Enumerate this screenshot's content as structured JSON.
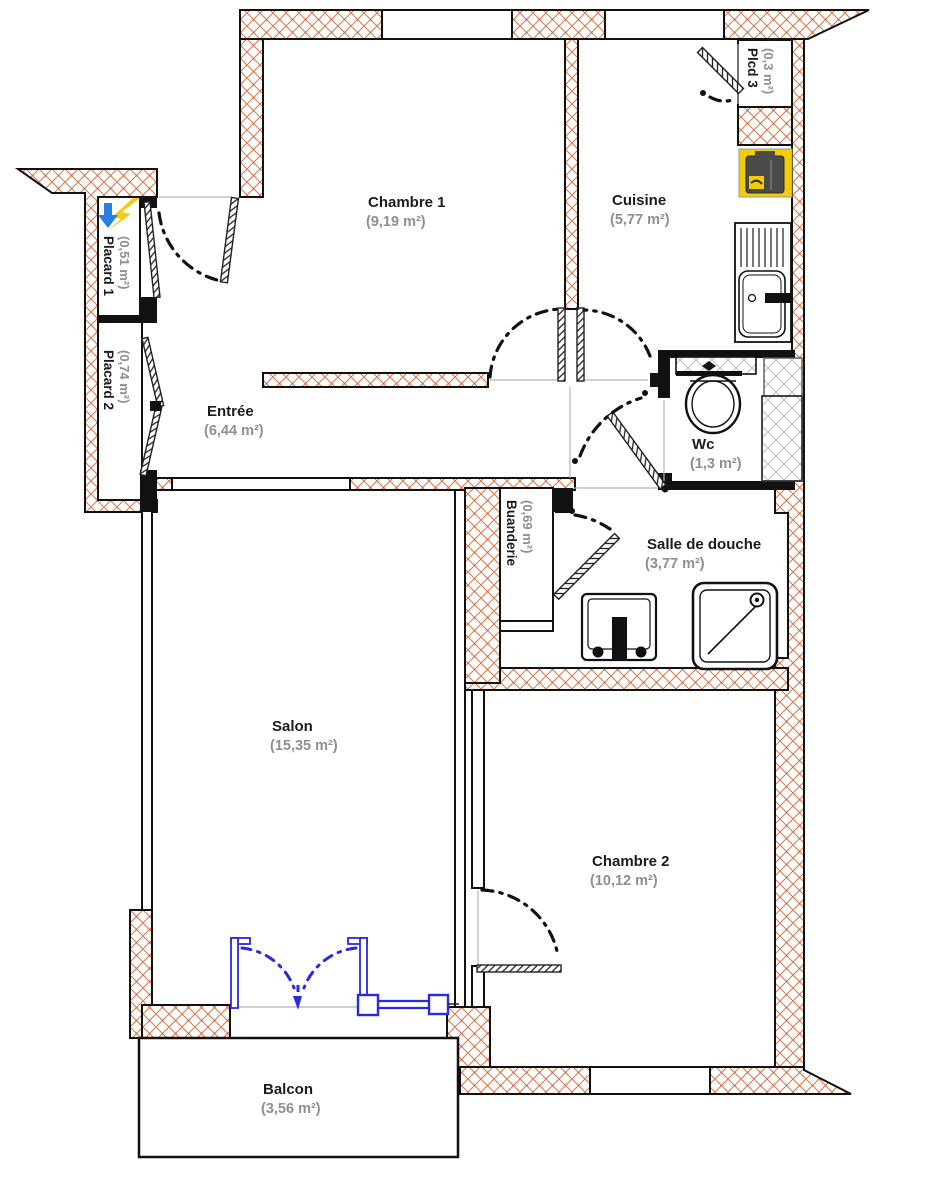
{
  "plan": {
    "title": "apartment-floor-plan",
    "rooms": {
      "chambre1": {
        "name": "Chambre 1",
        "area": "(9,19 m²)"
      },
      "cuisine": {
        "name": "Cuisine",
        "area": "(5,77 m²)"
      },
      "entree": {
        "name": "Entrée",
        "area": "(6,44 m²)"
      },
      "wc": {
        "name": "Wc",
        "area": "(1,3 m²)"
      },
      "salle_de_douche": {
        "name": "Salle de douche",
        "area": "(3,77 m²)"
      },
      "salon": {
        "name": "Salon",
        "area": "(15,35 m²)"
      },
      "chambre2": {
        "name": "Chambre 2",
        "area": "(10,12 m²)"
      },
      "balcon": {
        "name": "Balcon",
        "area": "(3,56 m²)"
      },
      "placard1": {
        "name": "Placard 1",
        "area": "(0,51 m²)"
      },
      "placard2": {
        "name": "Placard 2",
        "area": "(0,74 m²)"
      },
      "placard3": {
        "name": "Plcd 3",
        "area": "(0,3 m²)"
      },
      "buanderie": {
        "name": "Buanderie",
        "area": "(0,69 m²)"
      }
    },
    "icons": {
      "kitchen_sink": "sink-with-drainer-icon",
      "stove": "stove-icon",
      "toilet": "toilet-icon",
      "washbasin": "washbasin-icon",
      "shower": "shower-tray-icon",
      "electric_panel": "electric-panel-icon",
      "balcony_doors": "french-doors-icon",
      "balcony_window": "window-icon"
    },
    "colors": {
      "wall_hatch": "#dd7b52",
      "balcony_feature": "#2a2ae0",
      "appliance_accent": "#f2cc0c",
      "fixture_dark": "#4a4a4a",
      "area_text": "#8f8f8f",
      "name_text": "#1c1c1c"
    }
  }
}
